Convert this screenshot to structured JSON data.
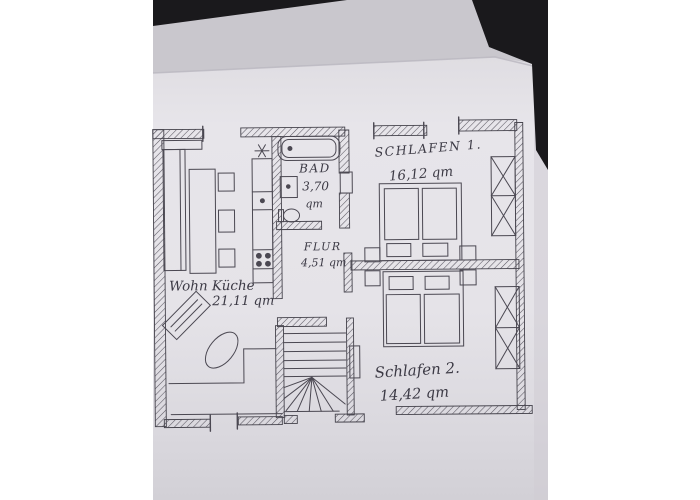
{
  "photo": {
    "paper_color": "#e6e4e9",
    "fold_band_color": "#c9c7cd",
    "background_color": "#1a191c",
    "pencil_color": "#4b4852"
  },
  "floorplan": {
    "rooms": {
      "schlafen1": {
        "label": "SCHLAFEN 1.",
        "area": "16,12 qm"
      },
      "bad": {
        "label": "BAD",
        "area_value": "3,70",
        "area_unit": "qm"
      },
      "flur": {
        "label": "FLUR",
        "area": "4,51 qm"
      },
      "wohnkueche": {
        "label": "Wohn Küche",
        "area": "21,11 qm"
      },
      "schlafen2": {
        "label": "Schlafen 2.",
        "area": "14,42 qm"
      }
    }
  }
}
